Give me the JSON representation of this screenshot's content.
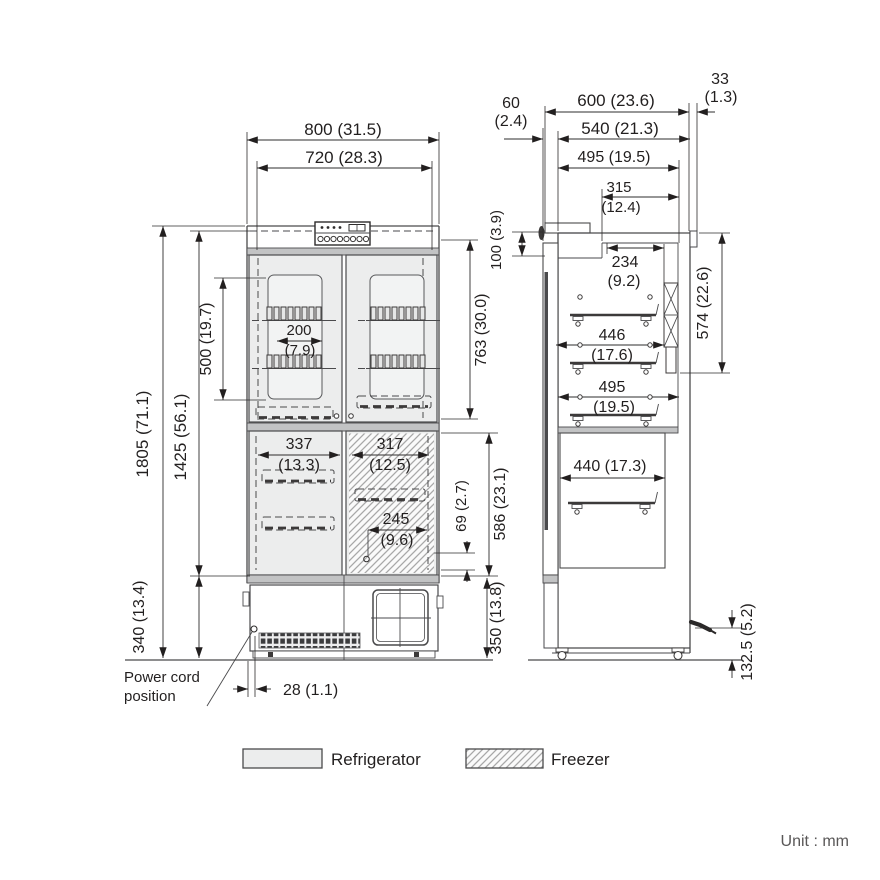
{
  "drawing_title": "refrigerator-freezer-dimension-drawing",
  "front": {
    "overall_width": "800 (31.5)",
    "door_width": "720 (28.3)",
    "overall_height": "1805 (71.1)",
    "cabinet_height": "1425 (56.1)",
    "window_height": "500 (19.7)",
    "rack_width_mm": "200",
    "rack_width_in": "(7.9)",
    "upper_door_height": "763 (30.0)",
    "lower_left_width_mm": "337",
    "lower_left_width_in": "(13.3)",
    "freezer_width_mm": "317",
    "freezer_width_in": "(12.5)",
    "freezer_inner_mm": "245",
    "freezer_inner_in": "(9.6)",
    "freezer_offset": "69 (2.7)",
    "lower_door_height": "586 (23.1)",
    "base_height": "340 (13.4)",
    "machine_height": "350 (13.8)",
    "cord_offset": "28 (1.1)"
  },
  "side": {
    "door_thickness_mm": "60",
    "door_thickness_in": "(2.4)",
    "overall_depth": "600 (23.6)",
    "rear_gap_mm": "33",
    "rear_gap_in": "(1.3)",
    "body_depth": "540 (21.3)",
    "top_inner_depth": "495 (19.5)",
    "top_recess_mm": "315",
    "top_recess_in": "(12.4)",
    "top_step": "100 (3.9)",
    "duct_depth_mm": "234",
    "duct_depth_in": "(9.2)",
    "upper_inner_height": "574 (22.6)",
    "shelf_depth_mm": "446",
    "shelf_depth_in": "(17.6)",
    "inner_depth_mm": "495",
    "inner_depth_in": "(19.5)",
    "lower_inner_depth": "440 (17.3)",
    "cord_height": "132.5 (5.2)"
  },
  "annotations": {
    "power_cord_line1": "Power cord",
    "power_cord_line2": "position"
  },
  "legend": {
    "refrigerator": "Refrigerator",
    "freezer": "Freezer"
  },
  "unit_note": "Unit : mm",
  "colors": {
    "line": "#4a4a4c",
    "text": "#221f1f",
    "door_fill": "#eceded",
    "band_fill": "#c2c3c4",
    "hatch_line": "#a8a8a8",
    "muted_text": "#595757"
  }
}
